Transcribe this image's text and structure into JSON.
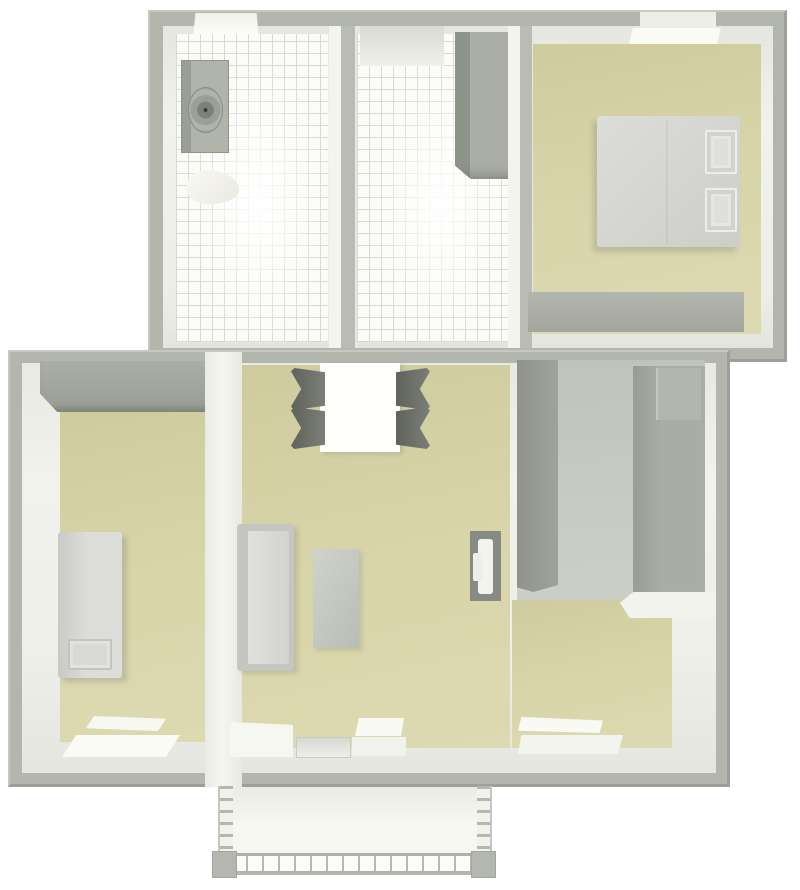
{
  "scene": {
    "type": "3d-floor-plan-top-view",
    "description": "Top-down 3D architectural rendering of an apartment with upper wing (bathroom, tiled hallway, bedroom), lower wing (second bedroom, living-dining room, gray storage room) and a balcony with lattice railing at the bottom",
    "rooms": [
      {
        "name": "bathroom",
        "floor": "white-tile",
        "furniture": [
          "washing-machine",
          "toilet"
        ],
        "windows": 1
      },
      {
        "name": "hallway",
        "floor": "white-tile",
        "furniture": [
          "tall-cabinet"
        ],
        "features": [
          "top-niche"
        ]
      },
      {
        "name": "bedroom",
        "floor": "beige",
        "furniture": [
          "double-bed",
          "pillow",
          "pillow",
          "low-dresser"
        ],
        "windows": 1
      },
      {
        "name": "left-bedroom",
        "floor": "beige",
        "furniture": [
          "wardrobe",
          "single-bed"
        ],
        "windows": 1
      },
      {
        "name": "living-dining-room",
        "floor": "beige",
        "furniture": [
          "dining-table",
          "chair",
          "chair",
          "chair",
          "chair",
          "sofa",
          "coffee-table",
          "tv-stand"
        ],
        "windows": 2,
        "doors": [
          "balcony-door"
        ]
      },
      {
        "name": "storage-room",
        "floor": "gray",
        "furniture": [
          "wardrobe-strip",
          "tall-cabinet",
          "top-box"
        ]
      },
      {
        "name": "balcony",
        "floor": "white",
        "features": [
          "lattice-railing",
          "side-rail",
          "side-rail",
          "corner-post",
          "corner-post"
        ]
      }
    ],
    "colors": {
      "wall_outer": "#b3b6ad",
      "wall_outer_light": "#c6c9c0",
      "wall_outer_dark": "#9da096",
      "wall_inner": "#f2f2ed",
      "wall_inner_shade": "#e6e6e0",
      "floor_beige": "#d8d5aa",
      "floor_beige_dark": "#cecb9e",
      "tile_base": "#fbfbf7",
      "tile_line": "#d9d9d1",
      "floor_gray": "#c6c8c2",
      "furniture_light": "#d8d9d5",
      "furniture_mid": "#b5b8b1",
      "furniture_dark": "#9a9e96",
      "chair_dark": "#6e726b",
      "soft_white": "#f8f8f3"
    }
  }
}
